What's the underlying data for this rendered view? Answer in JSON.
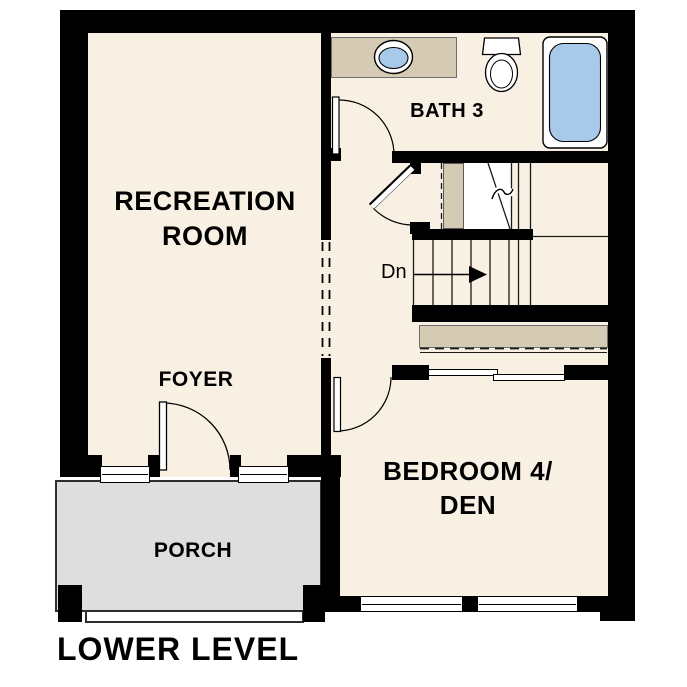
{
  "title": "LOWER LEVEL",
  "rooms": {
    "recreation": {
      "label_line1": "RECREATION",
      "label_line2": "ROOM"
    },
    "foyer": {
      "label": "FOYER"
    },
    "bath": {
      "label": "BATH 3"
    },
    "bedroom": {
      "label_line1": "BEDROOM 4/",
      "label_line2": "DEN"
    },
    "porch": {
      "label": "PORCH"
    }
  },
  "stairs": {
    "down_label": "Dn"
  },
  "fixtures": [
    "vanity-counter",
    "oval-sink",
    "toilet",
    "bathtub",
    "closet-shelf",
    "sliding-closet-doors"
  ],
  "colors": {
    "floor": "#f8f0e2",
    "wall": "#000000",
    "tan": "#d5cab3",
    "porch": "#dedede",
    "fixture_blue": "#a9c9ea",
    "line": "#1a1a1a"
  }
}
